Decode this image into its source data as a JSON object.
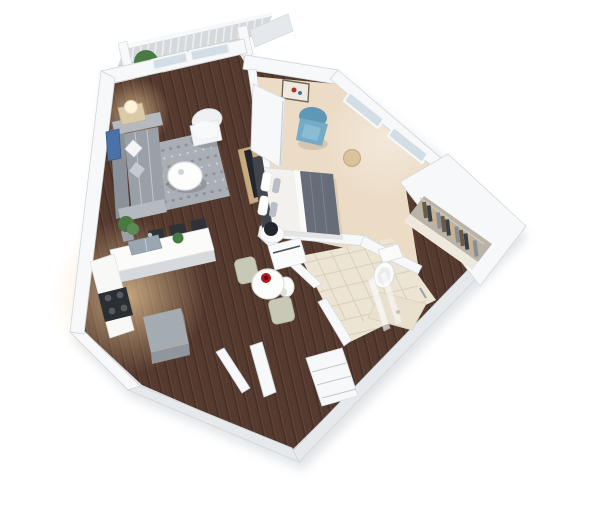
{
  "scene": {
    "type": "3d-floor-plan-render",
    "view": "isometric-top-down",
    "unit": "studio-apartment"
  },
  "palette": {
    "background": "#ffffff",
    "wall_top": "#f7f8fa",
    "wall_face": "#e6e9ec",
    "wall_edge": "#cfd4d9",
    "shadow": "#bdc3c9",
    "wood_base": "#54392e",
    "wood_light": "#7a574a",
    "wood_dark": "#38281f",
    "carpet": "#ecdcc6",
    "tile": "#ece5d4",
    "tile_line": "#d8cfbb",
    "closet_floor": "#efe9dd",
    "balcony_floor": "#d6d9dc",
    "rug": "#aaafb6",
    "rug_dark": "#84898f",
    "sofa": "#9aa0a7",
    "sofa_light": "#b4bac0",
    "white_furniture": "#f7f8f9",
    "wood_furniture": "#c9aa80",
    "tv_dark": "#23262b",
    "blanket": "#666d78",
    "headboard": "#40454e",
    "blue_chair": "#74abc7",
    "blue_chair_dark": "#5e98b6",
    "art_blue": "#4a71a8",
    "glass": "#d3dde6",
    "steel": "#9aa7b1",
    "red_accent": "#a8191f",
    "sage_chair": "#c8c8b6",
    "plant_green": "#4a7a44",
    "plant_dark": "#35592f",
    "cube_gray": "#a4abb1",
    "stool_dark": "#2e3339",
    "glow_warm": "#ffdfa8",
    "clothes_a": "#6b5a45",
    "clothes_b": "#3a3f46",
    "clothes_c": "#c9b28e",
    "clothes_d": "#8a8d93"
  },
  "rooms": [
    {
      "id": "balcony"
    },
    {
      "id": "living-room"
    },
    {
      "id": "kitchen"
    },
    {
      "id": "dining-nook"
    },
    {
      "id": "entry-hall"
    },
    {
      "id": "bedroom"
    },
    {
      "id": "bathroom"
    },
    {
      "id": "walk-in-closet"
    }
  ],
  "furniture": {
    "balcony": [
      "railing",
      "potted-plant"
    ],
    "living-room": [
      "sofa",
      "throw-pillows",
      "area-rug",
      "round-coffee-table",
      "white-armchair",
      "side-table-with-lamp",
      "wall-art-blue",
      "tv-console",
      "floor-plant"
    ],
    "kitchen": [
      "l-shaped-counter",
      "double-sink",
      "cooktop",
      "bar-stools",
      "gray-cube-ottoman",
      "counter-plant"
    ],
    "dining-nook": [
      "round-pedestal-table",
      "red-bowl",
      "two-chairs"
    ],
    "entry-hall": [
      "storage-cabinet",
      "open-door"
    ],
    "bedroom": [
      "queen-bed",
      "gray-duvet",
      "pillows",
      "nightstand-with-black-lamp",
      "blue-accent-chair",
      "framed-art",
      "round-pouf",
      "sliding-barn-door",
      "corner-windows"
    ],
    "bathroom": [
      "vanity",
      "vessel-sink",
      "toilet",
      "walk-in-shower",
      "glass-panel"
    ],
    "walk-in-closet": [
      "hanging-clothes",
      "closet-rod"
    ]
  }
}
